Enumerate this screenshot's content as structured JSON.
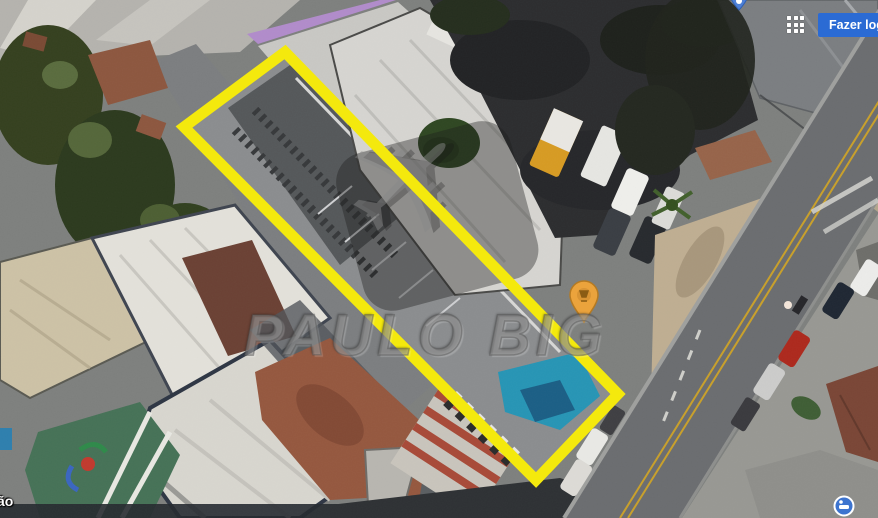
{
  "header": {
    "login_label": "Fazer login"
  },
  "watermark": {
    "brand_text": "PAULO BIG"
  },
  "map": {
    "street_label_partial": "ão",
    "view_type": "satellite"
  },
  "icons": {
    "apps_grid": "3x3-dot-grid",
    "airplane_glyph": "✈",
    "poi_pin": "amber-teardrop-marker",
    "blue_pin": "blue-teardrop-marker",
    "blue_circle_poi": "blue-circle-marker"
  },
  "colors": {
    "highlight": "#f4e90d",
    "login-btn": "#2b6bd4",
    "poi-pin": "#eba33c",
    "road-centerline": "#c9a02a"
  }
}
